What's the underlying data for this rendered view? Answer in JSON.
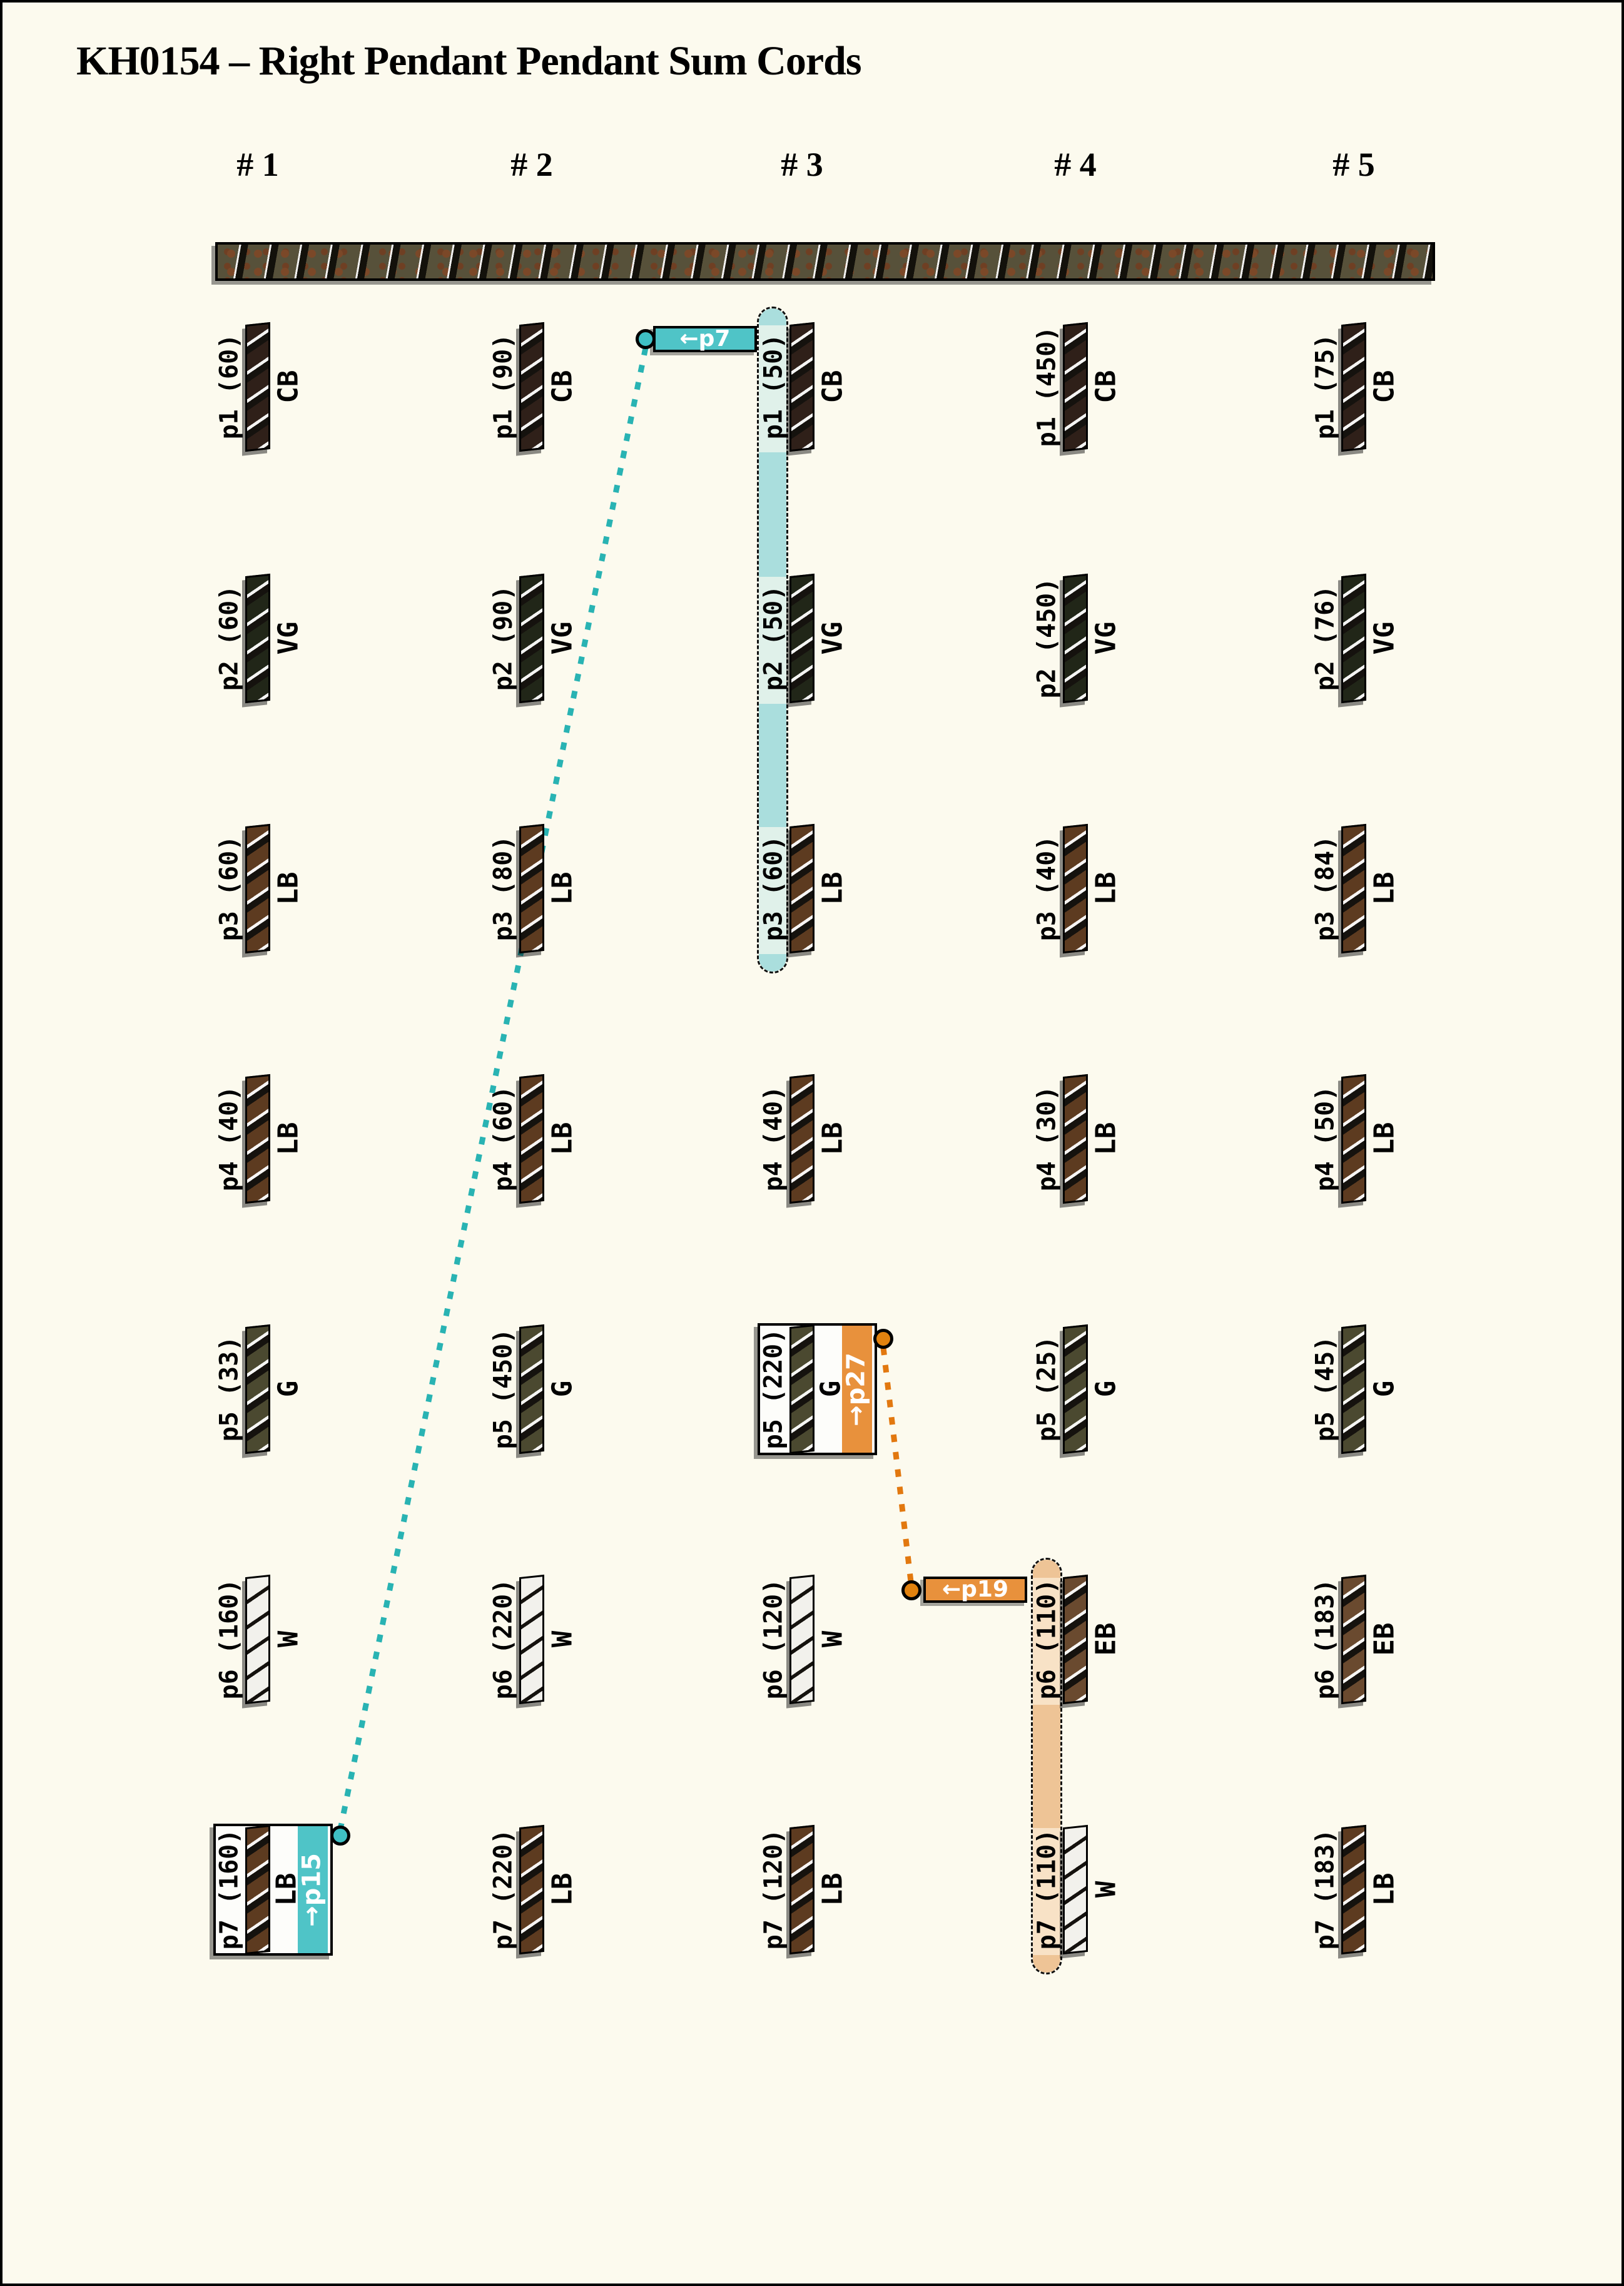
{
  "title": "KH0154 – Right Pendant Pendant Sum Cords",
  "columns": [
    {
      "header": "# 1",
      "pendants": [
        {
          "label": "p1 (60)",
          "code": "CB"
        },
        {
          "label": "p2 (60)",
          "code": "VG"
        },
        {
          "label": "p3 (60)",
          "code": "LB"
        },
        {
          "label": "p4 (40)",
          "code": "LB"
        },
        {
          "label": "p5 (33)",
          "code": "G"
        },
        {
          "label": "p6 (160)",
          "code": "W"
        },
        {
          "label": "p7 (160)",
          "code": "LB"
        }
      ]
    },
    {
      "header": "# 2",
      "pendants": [
        {
          "label": "p1 (90)",
          "code": "CB"
        },
        {
          "label": "p2 (90)",
          "code": "VG"
        },
        {
          "label": "p3 (80)",
          "code": "LB"
        },
        {
          "label": "p4 (60)",
          "code": "LB"
        },
        {
          "label": "p5 (450)",
          "code": "G"
        },
        {
          "label": "p6 (220)",
          "code": "W"
        },
        {
          "label": "p7 (220)",
          "code": "LB"
        }
      ]
    },
    {
      "header": "# 3",
      "pendants": [
        {
          "label": "p1 (50)",
          "code": "CB"
        },
        {
          "label": "p2 (50)",
          "code": "VG"
        },
        {
          "label": "p3 (60)",
          "code": "LB"
        },
        {
          "label": "p4 (40)",
          "code": "LB"
        },
        {
          "label": "p5 (220)",
          "code": "G"
        },
        {
          "label": "p6 (120)",
          "code": "W"
        },
        {
          "label": "p7 (120)",
          "code": "LB"
        }
      ]
    },
    {
      "header": "# 4",
      "pendants": [
        {
          "label": "p1 (450)",
          "code": "CB"
        },
        {
          "label": "p2 (450)",
          "code": "VG"
        },
        {
          "label": "p3 (40)",
          "code": "LB"
        },
        {
          "label": "p4 (30)",
          "code": "LB"
        },
        {
          "label": "p5 (25)",
          "code": "G"
        },
        {
          "label": "p6 (110)",
          "code": "EB"
        },
        {
          "label": "p7 (110)",
          "code": "W"
        }
      ]
    },
    {
      "header": "# 5",
      "pendants": [
        {
          "label": "p1 (75)",
          "code": "CB"
        },
        {
          "label": "p2 (76)",
          "code": "VG"
        },
        {
          "label": "p3 (84)",
          "code": "LB"
        },
        {
          "label": "p4 (50)",
          "code": "LB"
        },
        {
          "label": "p5 (45)",
          "code": "G"
        },
        {
          "label": "p6 (183)",
          "code": "EB"
        },
        {
          "label": "p7 (183)",
          "code": "LB"
        }
      ]
    }
  ],
  "links": {
    "teal": {
      "pointer_label": "←p7",
      "strip_label": "→p15",
      "line_color": "#29b3b3",
      "fill": "#4fc4c7",
      "highlight_light": "#e0f1ea",
      "highlight_dark": "#aadedd"
    },
    "orange": {
      "pointer_label": "←p19",
      "strip_label": "→p27",
      "line_color": "#e2780f",
      "fill": "#e8913c",
      "highlight_light": "#f8e2c6",
      "highlight_dark": "#eec496"
    }
  },
  "colors": {
    "CB": "#2f2019",
    "VG": "#212618",
    "LB": "#5d3b20",
    "G": "#4b4930",
    "W": "#f2f1ec",
    "EB": "#6a4a2f",
    "background": "#fcfaee"
  }
}
